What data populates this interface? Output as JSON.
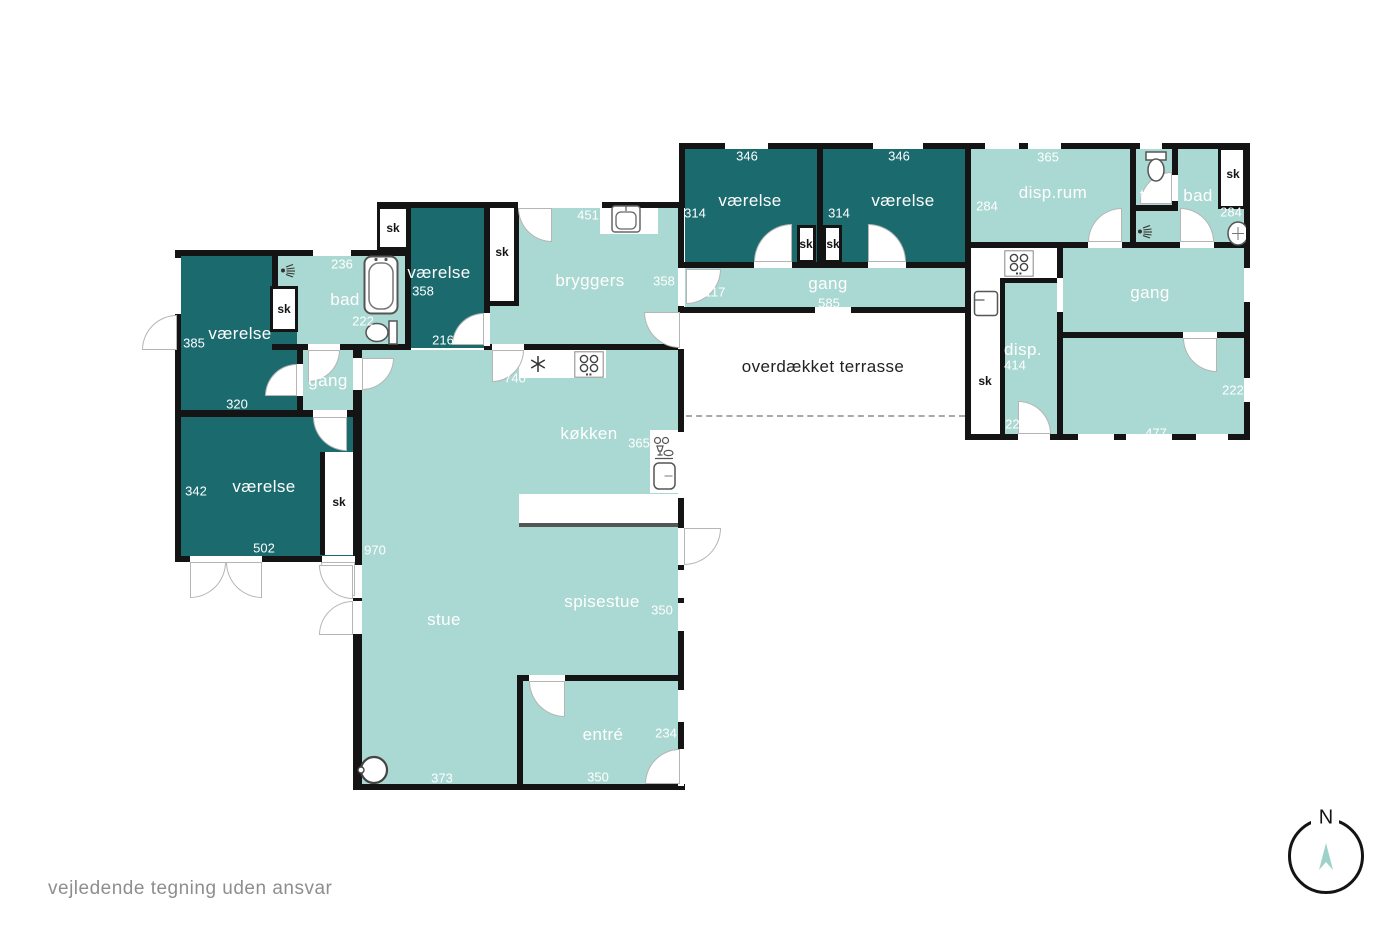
{
  "footer": {
    "disclaimer": "vejledende tegning uden ansvar"
  },
  "compass": {
    "north": "N"
  },
  "terrace": {
    "label": "overdækket terrasse"
  },
  "closet": "sk",
  "colors": {
    "room_dark": "#1a6a6e",
    "room_light": "#aad8d2",
    "wall": "#141414",
    "dash": "#a8a8a8",
    "footer": "#8e8e8e",
    "arrow": "#9ed1c9"
  },
  "icons": [
    "toilet-icon",
    "bathtub-icon",
    "shower-icon",
    "sink-icon",
    "stove-icon",
    "freezer-icon",
    "fridge-icon",
    "dishwasher-icon",
    "wood-stove-icon",
    "compass-icon"
  ],
  "rooms": {
    "bedroom_ne1": {
      "label": "værelse",
      "top": "346",
      "side": "314"
    },
    "bedroom_ne2": {
      "label": "værelse",
      "top": "346",
      "side": "314"
    },
    "disp_rum": {
      "label": "disp.rum",
      "top": "365",
      "side": "284"
    },
    "toi": {
      "label": "toi."
    },
    "bath_e": {
      "label": "bad",
      "side": "284"
    },
    "hall_n": {
      "label": "gang",
      "bottom": "585",
      "door": "117"
    },
    "hall_e": {
      "label": "gang"
    },
    "disp": {
      "label": "disp.",
      "side": "414",
      "bottom": "222"
    },
    "room_se": {
      "side": "222",
      "bottom": "477"
    },
    "bedroom_nw": {
      "label": "værelse",
      "side": "385",
      "bottom": "320"
    },
    "bath_w": {
      "label": "bad",
      "top": "236",
      "mid": "222"
    },
    "hall_w": {
      "label": "gang"
    },
    "bedroom_sw": {
      "label": "værelse",
      "side": "342",
      "bottom": "502"
    },
    "bedroom_c": {
      "label": "værelse",
      "size": "358",
      "bottom": "216"
    },
    "bryggers": {
      "label": "bryggers",
      "top": "451",
      "side": "358"
    },
    "kitchen": {
      "label": "køkken",
      "side": "365",
      "top": "740"
    },
    "living": {
      "label": "stue",
      "side": "970",
      "bottom": "373"
    },
    "dining": {
      "label": "spisestue",
      "side": "350"
    },
    "entry": {
      "label": "entré",
      "side": "234",
      "bottom": "350"
    }
  }
}
